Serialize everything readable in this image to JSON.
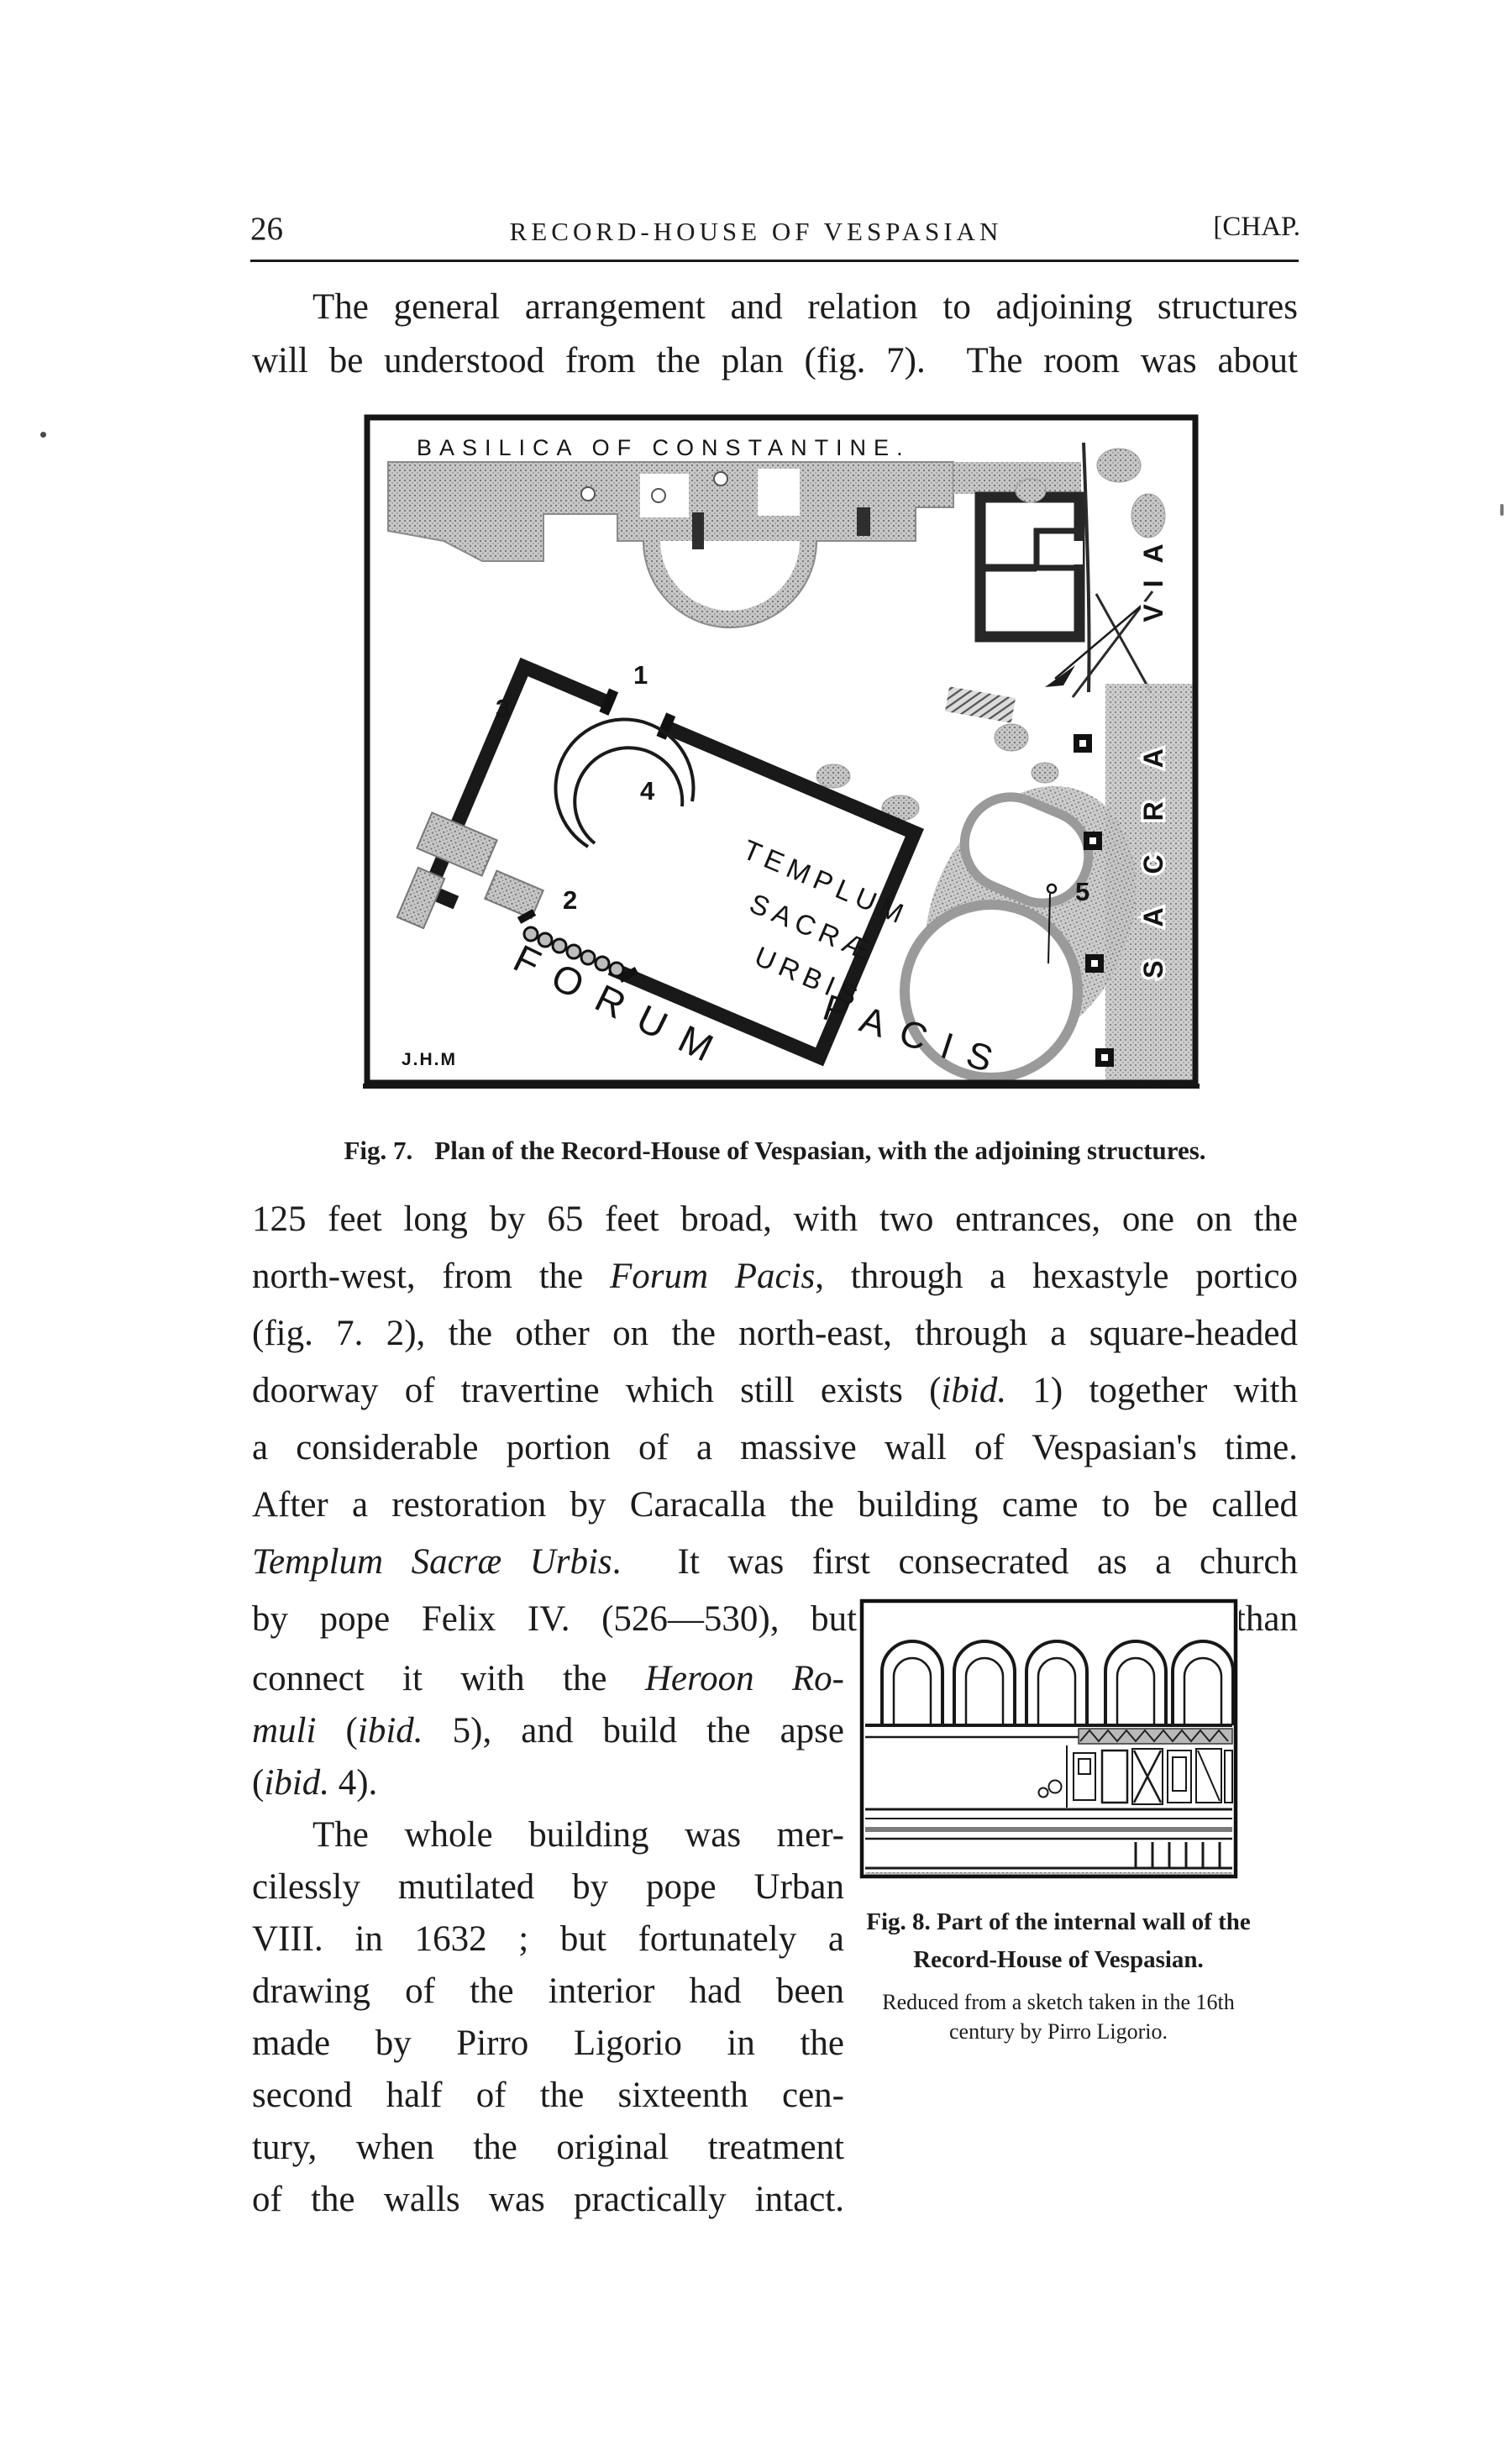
{
  "page": {
    "number": "26",
    "running_title": "RECORD-HOUSE OF VESPASIAN",
    "chapter_mark": "[CHAP."
  },
  "intro": {
    "lines": [
      [
        {
          "t": "The general arrangement and relation to adjoining structures"
        }
      ],
      [
        {
          "t": "will be understood from the plan (fig. 7).  The room was about"
        }
      ]
    ]
  },
  "fig7": {
    "caption_label": "Fig. 7.",
    "caption_text": "Plan of the Record-House of Vespasian, with the adjoining structures.",
    "labels": {
      "basilica": "BASILICA OF CONSTANTINE.",
      "templum_1": "TEMPLUM",
      "templum_2": "SACRÆ",
      "templum_3": "URBIS",
      "forum": "FORUM",
      "pacis": "PACIS",
      "sacra": "SACRA",
      "via": "VIA",
      "n1": "1",
      "n2": "2",
      "n3": "3",
      "n4": "4",
      "n5": "5",
      "initials": "J.H.M"
    }
  },
  "body": {
    "lines": [
      [
        {
          "t": "125 feet long by 65 feet broad, with two entrances, one on the"
        }
      ],
      [
        {
          "t": "north-west, from the "
        },
        {
          "t": "Forum Pacis",
          "i": true
        },
        {
          "t": ", through a hexastyle portico"
        }
      ],
      [
        {
          "t": "(fig. 7. 2), the other on the north-east, through a square-headed"
        }
      ],
      [
        {
          "t": "doorway of travertine which still exists ("
        },
        {
          "t": "ibid.",
          "i": true
        },
        {
          "t": " 1) together with"
        }
      ],
      [
        {
          "t": "a considerable portion of a massive wall of Vespasian's time."
        }
      ],
      [
        {
          "t": "After a restoration by Caracalla the building came to be called"
        }
      ],
      [
        {
          "t": "Templum Sacræ Urbis",
          "i": true
        },
        {
          "t": ".  It was first consecrated as a church"
        }
      ],
      [
        {
          "t": "by pope Felix IV. (526—530), but he did little more than"
        }
      ]
    ]
  },
  "left_column": {
    "lines": [
      [
        {
          "t": "connect it with the "
        },
        {
          "t": "Heroon Ro-",
          "i": true
        }
      ],
      [
        {
          "t": "muli",
          "i": true
        },
        {
          "t": " ("
        },
        {
          "t": "ibid.",
          "i": true
        },
        {
          "t": " 5), and build the apse"
        }
      ],
      [
        {
          "t": "("
        },
        {
          "t": "ibid.",
          "i": true
        },
        {
          "t": " 4)."
        }
      ],
      [
        {
          "t": "The whole building was mer-"
        }
      ],
      [
        {
          "t": "cilessly mutilated by pope Urban"
        }
      ],
      [
        {
          "t": "VIII. in 1632 ; but fortunately a"
        }
      ],
      [
        {
          "t": "drawing of the interior had been"
        }
      ],
      [
        {
          "t": "made by Pirro Ligorio in the"
        }
      ],
      [
        {
          "t": "second half of the sixteenth cen-"
        }
      ],
      [
        {
          "t": "tury, when the original treatment"
        }
      ],
      [
        {
          "t": "of the walls was practically intact."
        }
      ]
    ]
  },
  "fig8": {
    "caption_lines": [
      "Fig. 8.   Part of the internal wall of the",
      "Record-House of Vespasian."
    ],
    "note_lines": [
      "Reduced from a sketch taken in the 16th",
      "century by Pirro Ligorio."
    ]
  }
}
